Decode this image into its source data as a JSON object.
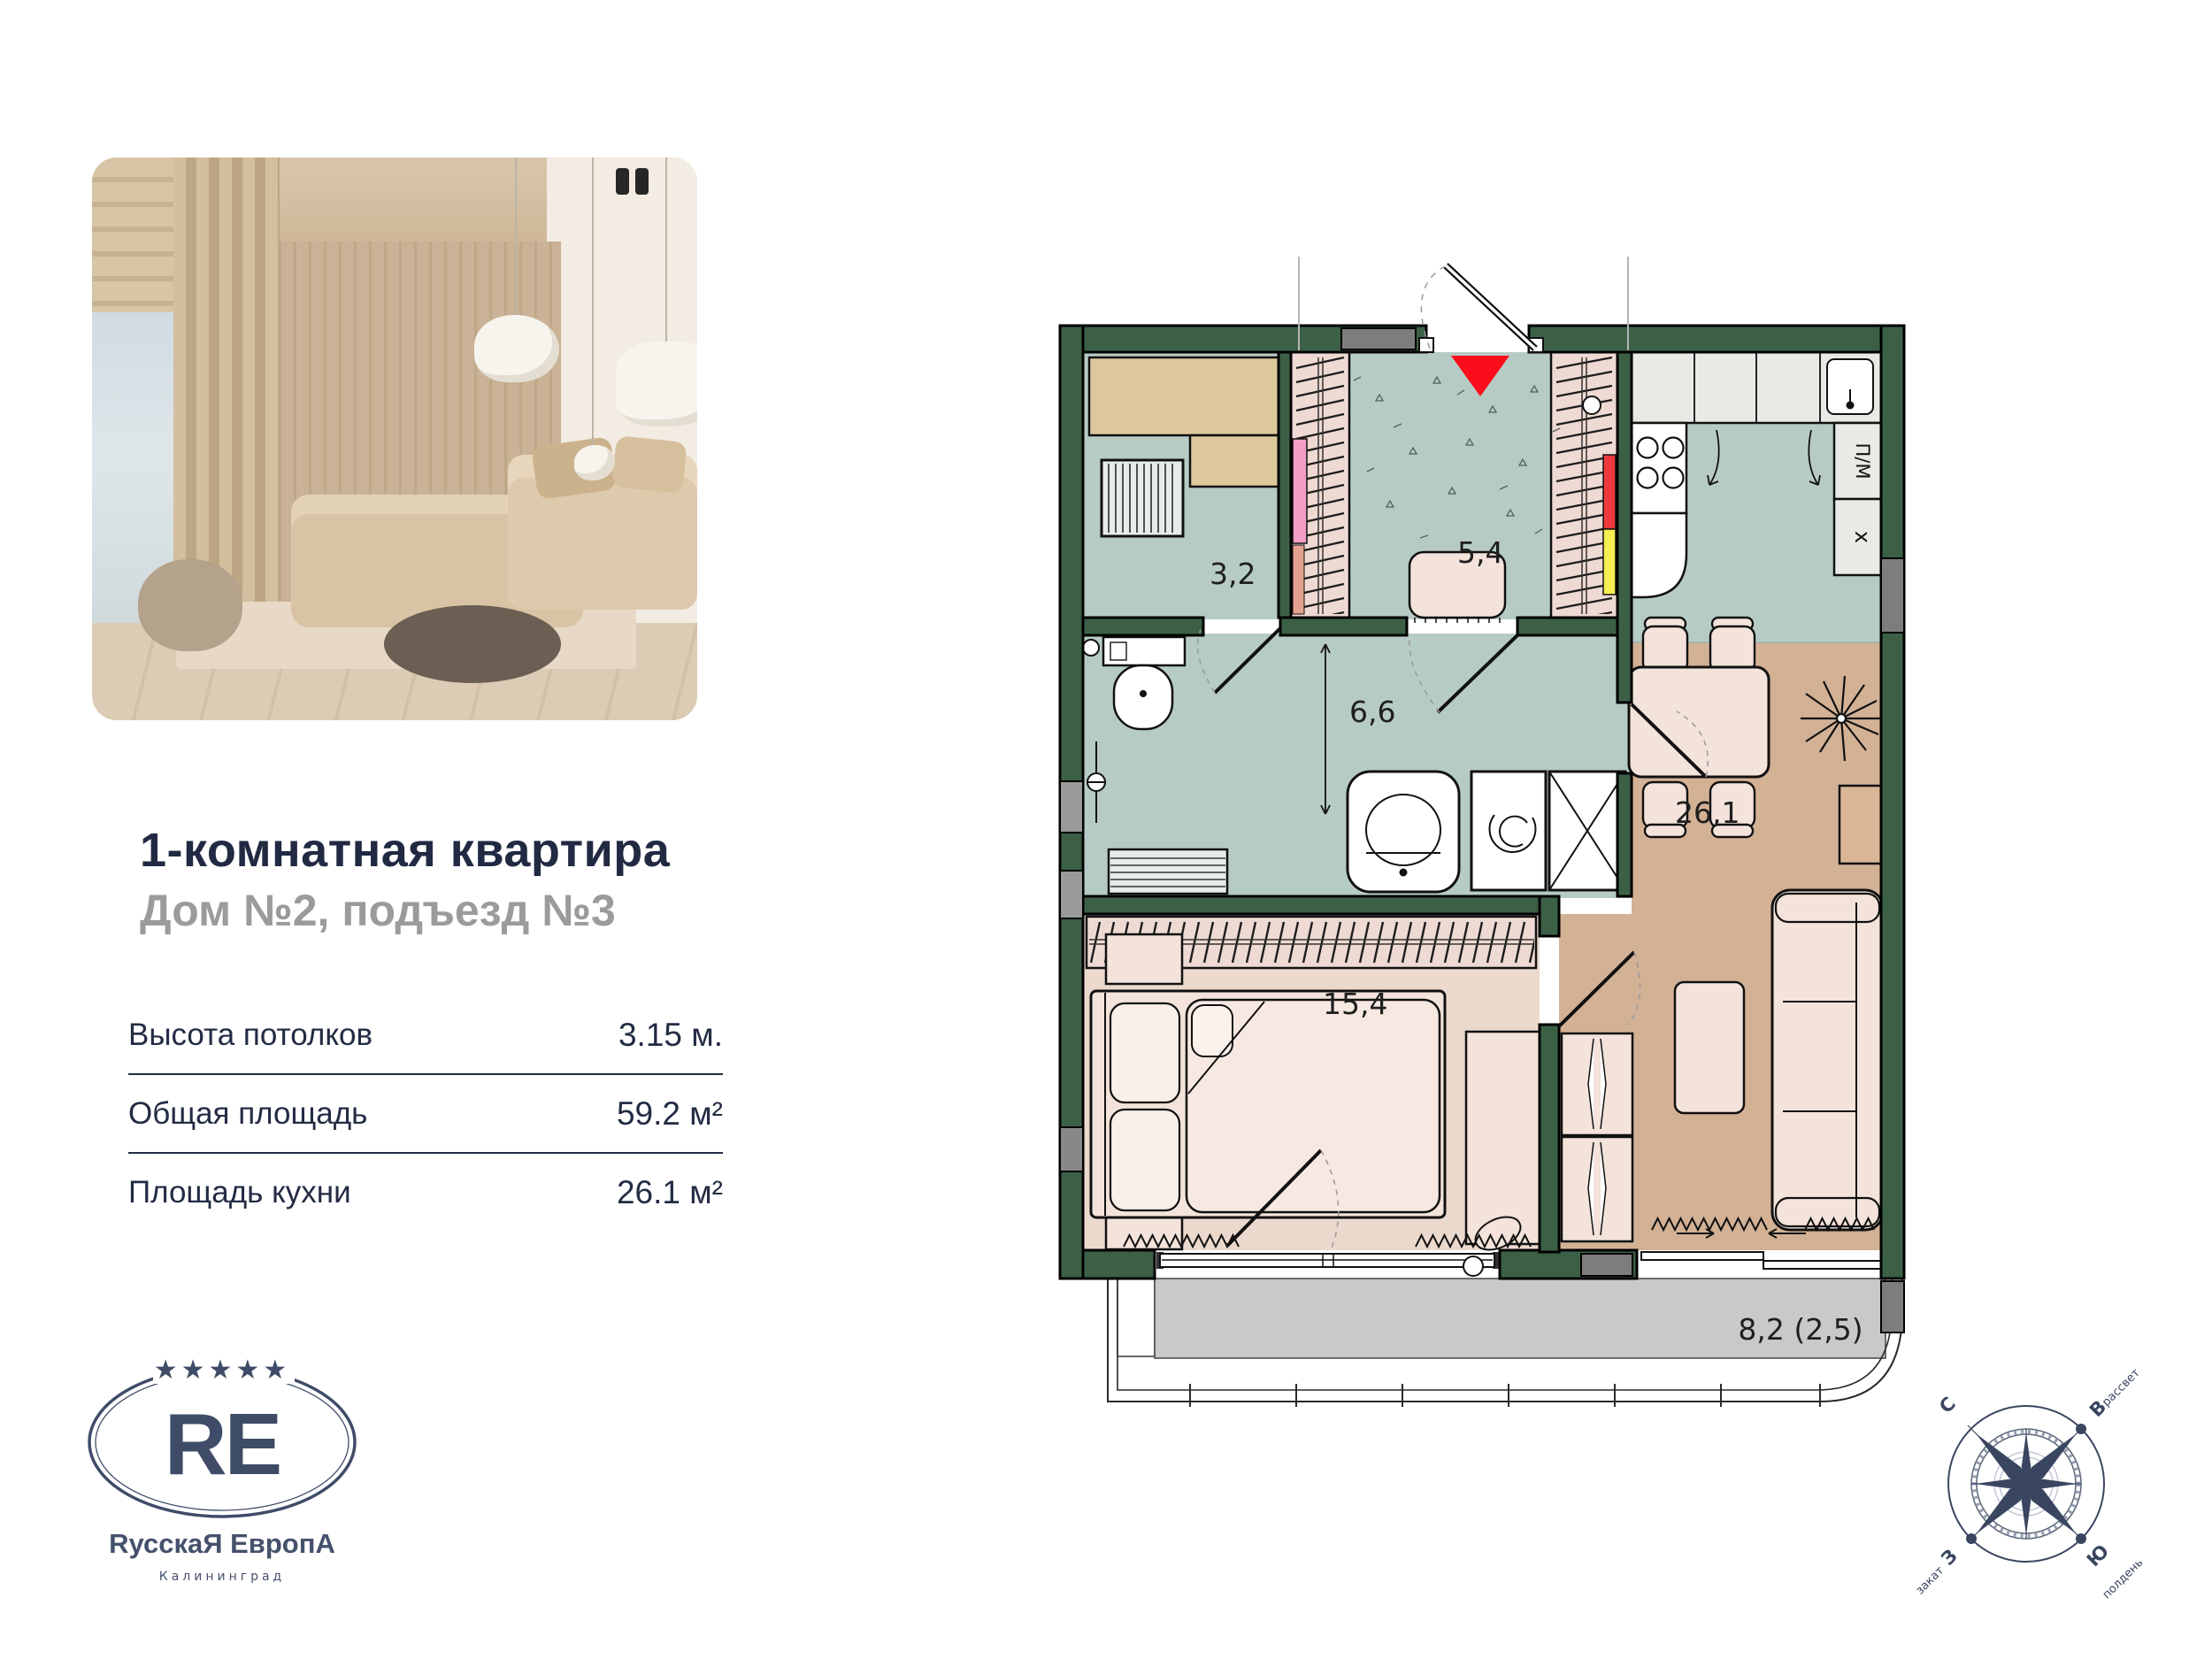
{
  "card": {
    "title": "1-комнатная квартира",
    "subtitle": "Дом №2, подъезд №3",
    "specs": [
      {
        "label": "Высота потолков",
        "value": "3.15 м."
      },
      {
        "label": "Общая площадь",
        "value": "59.2 м²"
      },
      {
        "label": "Площадь кухни",
        "value": "26.1 м²"
      }
    ]
  },
  "logo": {
    "monogram": "RE",
    "brand": "RусскаЯ ЕвропА",
    "city": "Калининград",
    "stars": "★★★★★"
  },
  "floorplan": {
    "rooms": [
      {
        "id": "storage",
        "area": "3,2"
      },
      {
        "id": "hallway",
        "area": "5,4"
      },
      {
        "id": "bathroom",
        "area": "6,6"
      },
      {
        "id": "bedroom",
        "area": "15,4"
      },
      {
        "id": "kitchen-living",
        "area": "26,1"
      },
      {
        "id": "balcony",
        "area": "8,2 (2,5)"
      }
    ],
    "kitchen": {
      "dishwasher": "П/М",
      "hood": "х"
    }
  },
  "compass": {
    "n": "С",
    "e": "В",
    "s": "Ю",
    "w": "З",
    "dawn": "рассвет",
    "noon": "полдень",
    "sunset": "закат"
  },
  "colors": {
    "wall": "#3b6046",
    "floor_wet": "#b7cbc5",
    "floor_living": "#d3b195",
    "floor_bedroom": "#ecd9cd",
    "floor_balcony": "#c9c9c9",
    "furniture": "#f3e3da",
    "wardrobe": "#eedad3",
    "shelf": "#dcc89c",
    "accent_red": "#ee3a3e",
    "accent_pink": "#f29ec6",
    "accent_yellow": "#f5ee52",
    "entrance": "#fb0d1b",
    "navy": "#232c44",
    "gray_text": "#9b9b9b"
  }
}
